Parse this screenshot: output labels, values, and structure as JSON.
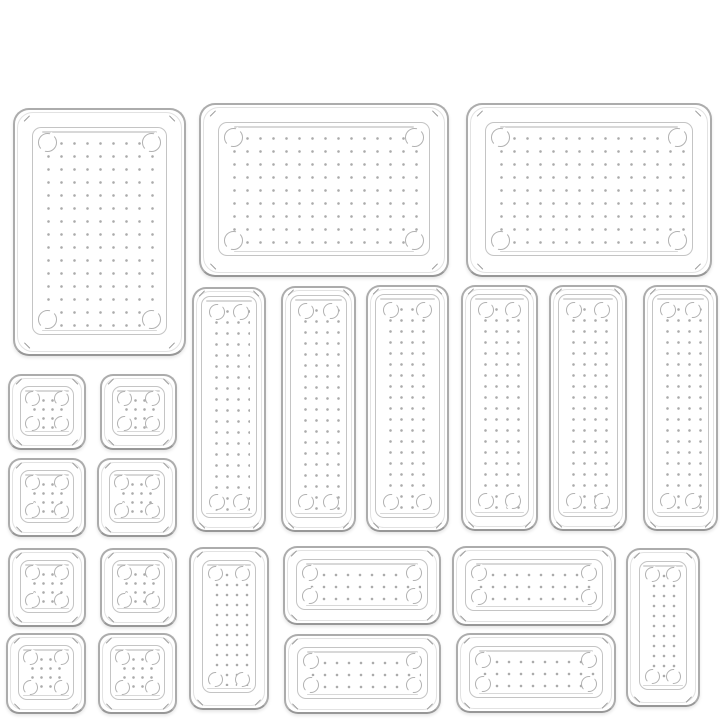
{
  "scene": {
    "subject": "23-piece clear plastic drawer organizer tray set, top-down product photo on white background",
    "width": 720,
    "height": 720,
    "background": "#ffffff",
    "colors": {
      "tray_outline": "#acacac",
      "tray_outline_bottom": "#979797",
      "rim_line": "#e2e2e2",
      "floor_line": "#c4c4c4",
      "shine_line": "#d8d8d8",
      "dot": "#ababab",
      "foot_circle": "#b1b1b1",
      "corner_tick": "#9a9a9a"
    },
    "kinds": {
      "L": {
        "label": "large-tray",
        "floorInset": 17,
        "floorBottomExtra": 2,
        "dotSpacing": 13,
        "circleSize": 19,
        "circleInset": 5,
        "radius": 16,
        "tickInset": 8
      },
      "VT": {
        "label": "tall-narrow-tray",
        "floorInset": 7,
        "floorBottomExtra": 5,
        "dotSpacing": 11,
        "circleSize": 16,
        "circleInset": 7,
        "radius": 14,
        "tickInset": 4
      },
      "SQ": {
        "label": "small-square-tray",
        "floorInset": 10,
        "floorBottomExtra": 2,
        "dotSpacing": 9,
        "circleSize": 15,
        "circleInset": 4,
        "radius": 13,
        "tickInset": 5
      },
      "HM": {
        "label": "medium-wide-tray",
        "floorInset": 11,
        "floorBottomExtra": 2,
        "dotSpacing": 12,
        "circleSize": 16,
        "circleInset": 5,
        "radius": 14,
        "tickInset": 5
      },
      "VM": {
        "label": "medium-vertical-tray",
        "floorInset": 11,
        "floorBottomExtra": 4,
        "dotSpacing": 10,
        "circleSize": 15,
        "circleInset": 5,
        "radius": 14,
        "tickInset": 5
      }
    },
    "trays": [
      {
        "name": "tray-large-portrait",
        "kind": "L",
        "x": 13,
        "y": 108,
        "w": 173,
        "h": 248
      },
      {
        "name": "tray-large-wide-center",
        "kind": "L",
        "x": 199,
        "y": 103,
        "w": 250,
        "h": 174
      },
      {
        "name": "tray-large-wide-right",
        "kind": "L",
        "x": 466,
        "y": 103,
        "w": 246,
        "h": 174
      },
      {
        "name": "tray-tall-1",
        "kind": "VT",
        "x": 192,
        "y": 287,
        "w": 74,
        "h": 245
      },
      {
        "name": "tray-tall-2",
        "kind": "VT",
        "x": 281,
        "y": 286,
        "w": 75,
        "h": 246
      },
      {
        "name": "tray-tall-3",
        "kind": "VT",
        "x": 366,
        "y": 285,
        "w": 83,
        "h": 247
      },
      {
        "name": "tray-tall-4",
        "kind": "VT",
        "x": 461,
        "y": 285,
        "w": 77,
        "h": 246
      },
      {
        "name": "tray-tall-5",
        "kind": "VT",
        "x": 549,
        "y": 285,
        "w": 78,
        "h": 246
      },
      {
        "name": "tray-tall-6",
        "kind": "VT",
        "x": 643,
        "y": 285,
        "w": 75,
        "h": 246
      },
      {
        "name": "tray-square-row1-col1",
        "kind": "SQ",
        "x": 8,
        "y": 374,
        "w": 78,
        "h": 76
      },
      {
        "name": "tray-square-row1-col2",
        "kind": "SQ",
        "x": 100,
        "y": 374,
        "w": 77,
        "h": 76
      },
      {
        "name": "tray-square-row2-col1",
        "kind": "SQ",
        "x": 8,
        "y": 458,
        "w": 78,
        "h": 79
      },
      {
        "name": "tray-square-row2-col2",
        "kind": "SQ",
        "x": 97,
        "y": 458,
        "w": 80,
        "h": 79
      },
      {
        "name": "tray-square-row3-col1",
        "kind": "SQ",
        "x": 8,
        "y": 548,
        "w": 78,
        "h": 79
      },
      {
        "name": "tray-square-row3-col2",
        "kind": "SQ",
        "x": 100,
        "y": 548,
        "w": 77,
        "h": 79
      },
      {
        "name": "tray-square-row4-col1",
        "kind": "SQ",
        "x": 6,
        "y": 633,
        "w": 80,
        "h": 81
      },
      {
        "name": "tray-square-row4-col2",
        "kind": "SQ",
        "x": 98,
        "y": 633,
        "w": 79,
        "h": 81
      },
      {
        "name": "tray-medium-vertical-left",
        "kind": "VM",
        "x": 189,
        "y": 547,
        "w": 80,
        "h": 163
      },
      {
        "name": "tray-medium-wide-top-left",
        "kind": "HM",
        "x": 283,
        "y": 546,
        "w": 158,
        "h": 79
      },
      {
        "name": "tray-medium-wide-bottom-left",
        "kind": "HM",
        "x": 284,
        "y": 634,
        "w": 157,
        "h": 80
      },
      {
        "name": "tray-medium-wide-top-right",
        "kind": "HM",
        "x": 452,
        "y": 546,
        "w": 164,
        "h": 80
      },
      {
        "name": "tray-medium-wide-bottom-right",
        "kind": "HM",
        "x": 456,
        "y": 633,
        "w": 160,
        "h": 80
      },
      {
        "name": "tray-medium-vertical-right",
        "kind": "VM",
        "x": 626,
        "y": 548,
        "w": 74,
        "h": 159
      }
    ]
  }
}
